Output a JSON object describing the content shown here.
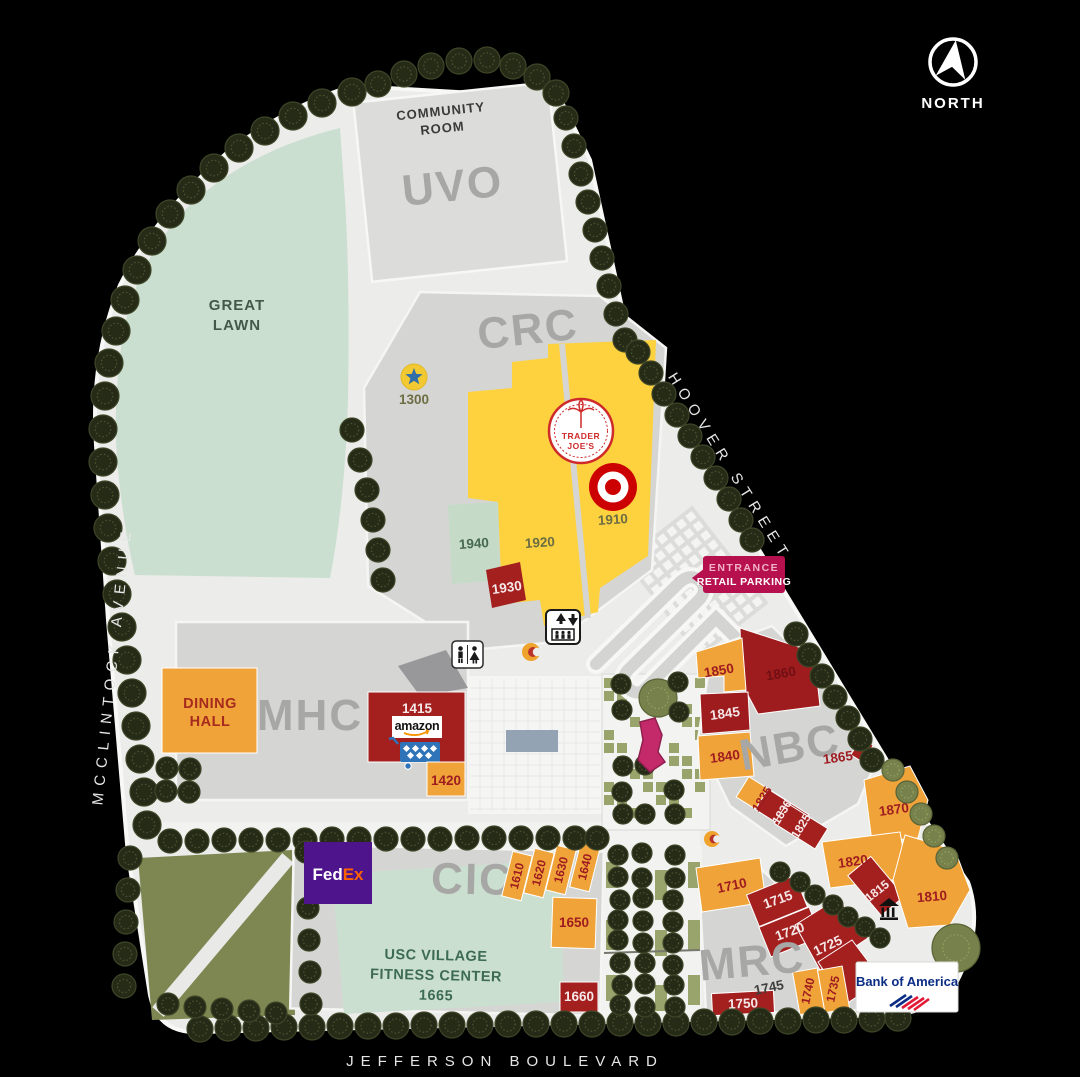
{
  "compass": {
    "label": "NORTH"
  },
  "streets": {
    "hoover": "HOOVER STREET",
    "mcclintock": "MCCLINTOCK AVENUE",
    "jefferson": "JEFFERSON BOULEVARD"
  },
  "areas": {
    "uvo": "UVO",
    "crc": "CRC",
    "mhc": "MHC",
    "nbc": "NBC",
    "cic": "CIC",
    "mrc": "MRC",
    "community_room": {
      "line1": "COMMUNITY",
      "line2": "ROOM"
    },
    "great_lawn": {
      "line1": "GREAT",
      "line2": "LAWN"
    },
    "dining_hall": {
      "line1": "DINING",
      "line2": "HALL"
    },
    "fitness_center": {
      "line1": "USC VILLAGE",
      "line2": "FITNESS CENTER",
      "number": "1665"
    }
  },
  "signs": {
    "entrance": {
      "line1": "ENTRANCE",
      "line2": "RETAIL PARKING"
    }
  },
  "logos": {
    "trader_joes": {
      "line1": "TRADER",
      "line2": "JOE'S"
    },
    "amazon": "amazon",
    "fedex": {
      "part1": "Fed",
      "part2": "Ex"
    },
    "bank_of_america": "Bank of America"
  },
  "units": {
    "1300": "1300",
    "1910": "1910",
    "1920": "1920",
    "1930": "1930",
    "1940": "1940",
    "1415": "1415",
    "1420": "1420",
    "1610": "1610",
    "1620": "1620",
    "1630": "1630",
    "1640": "1640",
    "1650": "1650",
    "1660": "1660",
    "1710": "1710",
    "1715": "1715",
    "1720": "1720",
    "1725": "1725",
    "1735": "1735",
    "1740": "1740",
    "1745": "1745",
    "1750": "1750",
    "1810": "1810",
    "1815": "1815",
    "1820": "1820",
    "1825": "1825",
    "1830": "1830",
    "1835": "1835",
    "1840": "1840",
    "1845": "1845",
    "1850": "1850",
    "1860": "1860",
    "1865": "1865",
    "1870": "1870"
  },
  "icons": {
    "north": "north-arrow",
    "restroom": "restroom",
    "elevator": "elevator",
    "bank": "bank-columns",
    "star": "star-marker",
    "statue": "statue-marker",
    "gold_marker": "trojan-marker",
    "target_logo": "target-bullseye",
    "tree": "tree"
  },
  "colors": {
    "background": "#000000",
    "site": "#ececea",
    "lawn_green": "#cbdfd0",
    "park_olive": "#7e8752",
    "building_gray": "#d5d5d3",
    "retail_yellow": "#fdd23e",
    "retail_orange": "#f0a339",
    "retail_red": "#a3201f",
    "entrance_pink": "#b6114e",
    "fedex_purple": "#4d148c",
    "fedex_orange": "#ff6200",
    "target_red": "#cc0000",
    "boa_blue": "#0b2d85",
    "boa_red": "#e31837",
    "tree_dark": "#262b18",
    "tree_light": "#76814b"
  }
}
